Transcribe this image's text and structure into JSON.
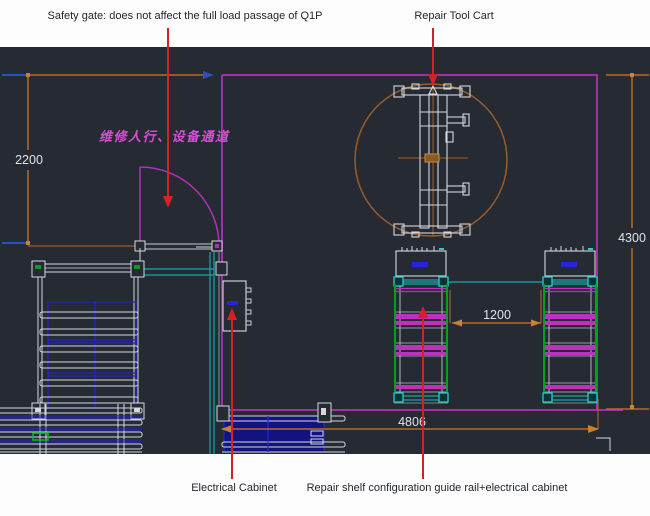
{
  "annotations": {
    "safety_gate": "Safety gate: does not affect the full load passage of Q1P",
    "repair_tool_cart": "Repair Tool Cart",
    "electrical_cabinet": "Electrical Cabinet",
    "repair_shelf": "Repair shelf configuration guide rail+electrical cabinet"
  },
  "drawing": {
    "passage_label": "维修人行、设备通道",
    "dimensions": {
      "left_height": "2200",
      "right_height": "4300",
      "shelf_gap": "1200",
      "bottom_width": "4806"
    }
  },
  "colors": {
    "canvas_bg": "#262b33",
    "boundary_magenta": "#a030a8",
    "dimension_orange": "#b96a28",
    "annotation_red": "#d42028",
    "rail_cyan": "#12a8a8",
    "rail_green": "#00a020",
    "rail_blue": "#2323cc",
    "line_white": "#d4d8dc",
    "passage_text_magenta": "#d44fd4"
  }
}
